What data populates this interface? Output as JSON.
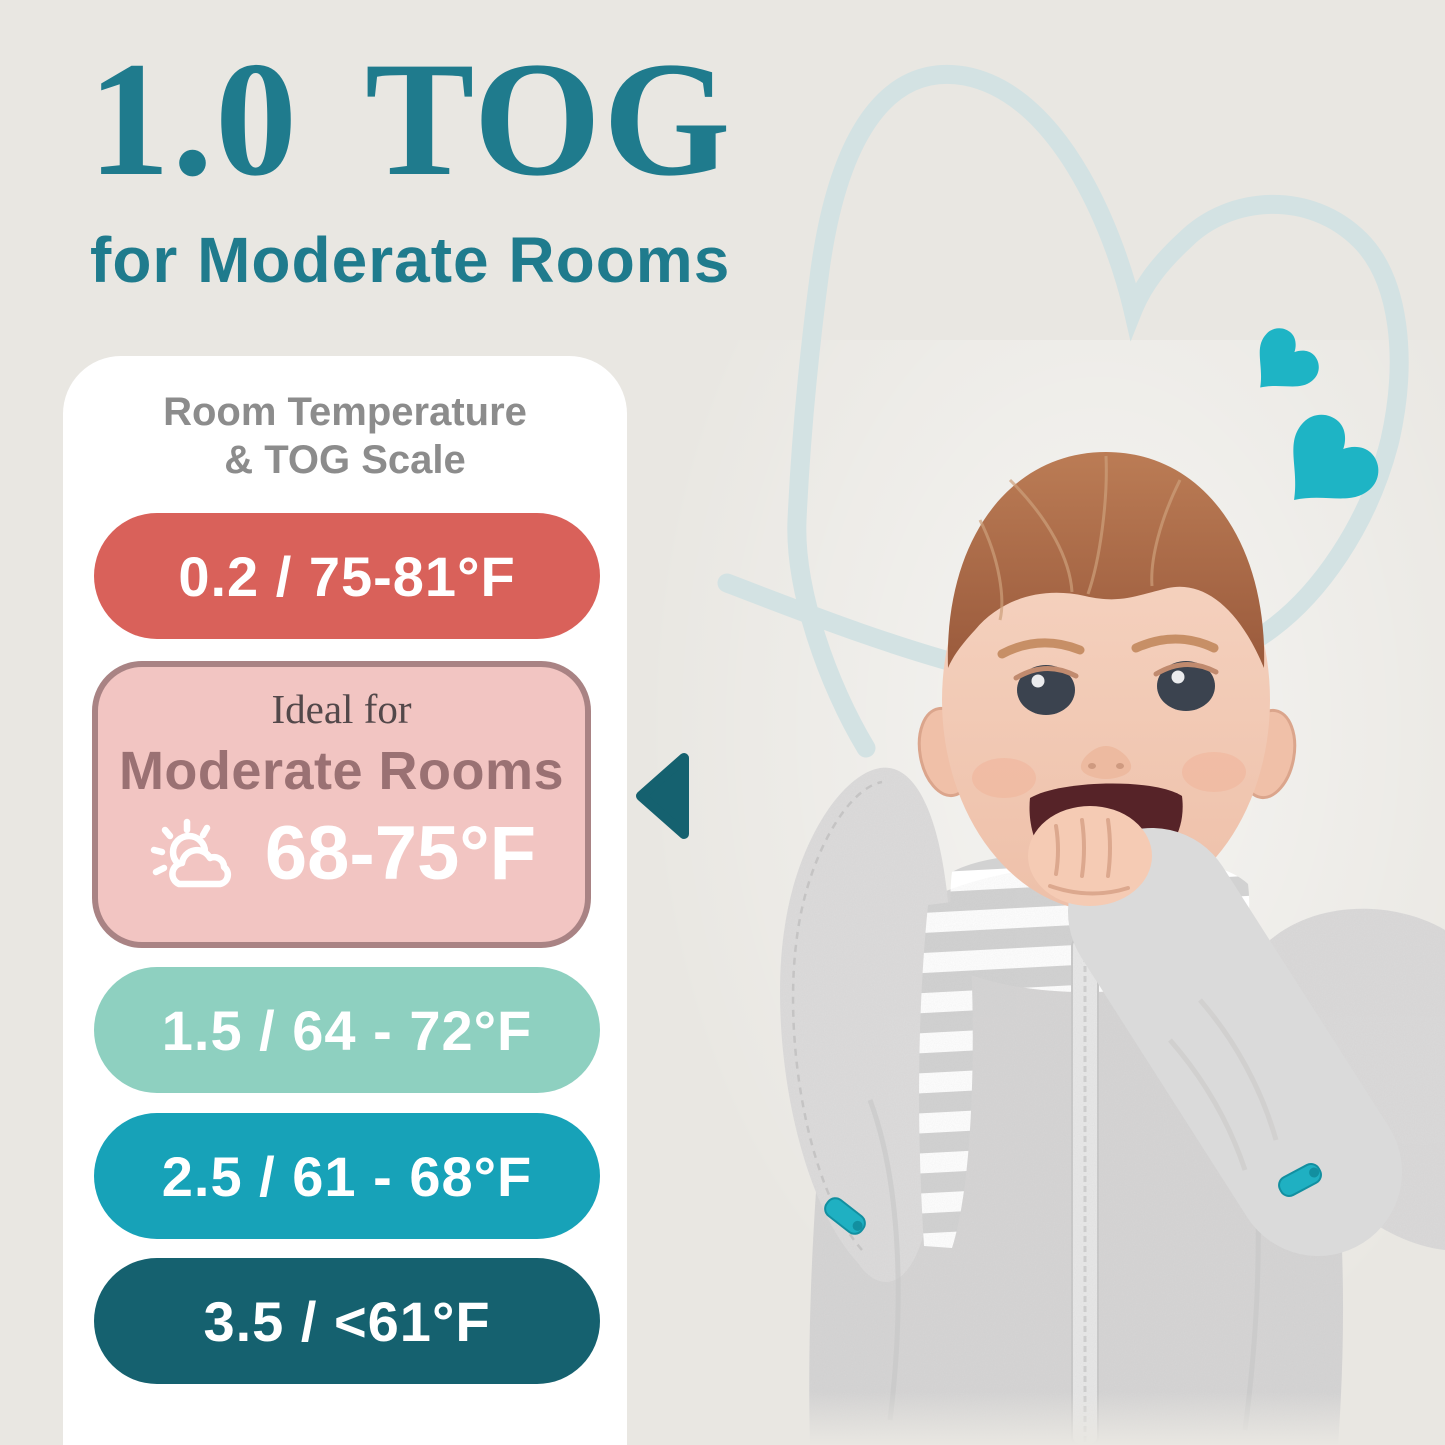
{
  "page": {
    "background": "#e9e7e2"
  },
  "hero": {
    "title": "1.0 TOG",
    "subtitle": "for Moderate Rooms"
  },
  "scale_panel": {
    "heading": {
      "line1": "Room Temperature",
      "line2": "& TOG Scale"
    },
    "rows": [
      {
        "tog": "0.2",
        "temp_f": "75-81°F",
        "label": "0.2 / 75-81°F",
        "bg": "#d9615a",
        "fg": "#ffffff"
      },
      {
        "tog": "1.5",
        "temp_f": "64 - 72°F",
        "label": "1.5 / 64 - 72°F",
        "bg": "#8ed0c0",
        "fg": "#ffffff"
      },
      {
        "tog": "2.5",
        "temp_f": "61 - 68°F",
        "label": "2.5 / 61 - 68°F",
        "bg": "#17a2b8",
        "fg": "#ffffff"
      },
      {
        "tog": "3.5",
        "temp_f": "<61°F",
        "label": "3.5 / <61°F",
        "bg": "#15616f",
        "fg": "#ffffff"
      }
    ],
    "ideal_card": {
      "tog": "1.0",
      "intro": "Ideal for",
      "room": "Moderate Rooms",
      "temp": "68-75°F",
      "icon": "sun-behind-cloud-icon",
      "bg": "#f2c5c2",
      "border": "#a98384",
      "intro_color": "#53484a",
      "room_color": "#9a7173",
      "temp_color": "#ffffff"
    }
  },
  "colors": {
    "title": "#1f7b8d",
    "heading_gray": "#8c8c8c",
    "panel_bg": "#ffffff",
    "pointer": "#15616f",
    "accent_heart": "#1eb4c5",
    "heart_outline": "#d3e2e3"
  },
  "photo": {
    "description": "Smiling baby lying down, hand in mouth, wearing a gray arms-up swaddle sack with striped inner shirt and teal zipper pulls",
    "swaddle_color": "#d9d8d8",
    "zip_pull_color": "#1fb0c2"
  }
}
